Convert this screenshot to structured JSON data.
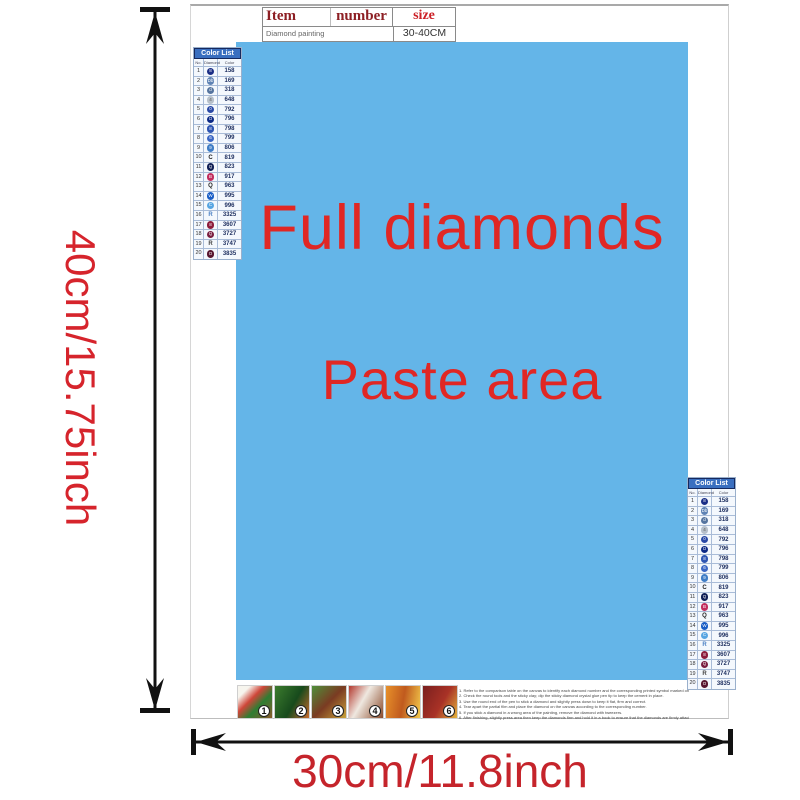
{
  "dimensions": {
    "height_label": "40cm/15.75inch",
    "width_label": "30cm/11.8inch"
  },
  "item_table": {
    "col_item": "Item",
    "col_number": "number",
    "col_size": "size",
    "item_value": "Diamond painting",
    "size_value": "30-40CM"
  },
  "paste_area": {
    "line1": "Full diamonds",
    "line2": "Paste area",
    "bg_color": "#64b5e8",
    "text_color": "#e02724"
  },
  "color_list": {
    "title": "Color List",
    "col_no": "No.",
    "col_diamond": "Diamond",
    "col_color": "Color",
    "rows": [
      {
        "no": "1",
        "symbol": "8",
        "circle": "#1b2e86",
        "code": "158"
      },
      {
        "no": "2",
        "symbol": "Db",
        "circle": "#5e82b4",
        "code": "169"
      },
      {
        "no": "3",
        "symbol": "d",
        "circle": "#55749f",
        "code": "318"
      },
      {
        "no": "4",
        "symbol": "4",
        "circle": "#b7c0ca",
        "glyph": "#555",
        "code": "648"
      },
      {
        "no": "5",
        "symbol": "0",
        "circle": "#2a49a6",
        "code": "792"
      },
      {
        "no": "6",
        "symbol": "O",
        "circle": "#0d2a86",
        "code": "796"
      },
      {
        "no": "7",
        "symbol": "8",
        "circle": "#2e55b2",
        "code": "798"
      },
      {
        "no": "8",
        "symbol": "6",
        "circle": "#3a66c4",
        "code": "799"
      },
      {
        "no": "9",
        "symbol": "9",
        "circle": "#3f7dc6",
        "code": "806"
      },
      {
        "no": "10",
        "symbol": "C",
        "letter": true,
        "letter_color": "#222",
        "code": "819"
      },
      {
        "no": "11",
        "symbol": "Q",
        "circle": "#101f56",
        "code": "823"
      },
      {
        "no": "12",
        "symbol": "B",
        "circle": "#c12d5e",
        "code": "917"
      },
      {
        "no": "13",
        "symbol": "Q",
        "letter": true,
        "letter_color": "#222",
        "code": "963"
      },
      {
        "no": "14",
        "symbol": "W",
        "circle": "#1a5ec6",
        "code": "995"
      },
      {
        "no": "15",
        "symbol": "C",
        "circle": "#57a5e2",
        "code": "996"
      },
      {
        "no": "16",
        "symbol": "R",
        "letter": true,
        "letter_color": "#4a80c4",
        "code": "3325"
      },
      {
        "no": "17",
        "symbol": "8",
        "circle": "#8d1c3c",
        "code": "3607"
      },
      {
        "no": "18",
        "symbol": "Q",
        "circle": "#7a1e40",
        "code": "3727"
      },
      {
        "no": "19",
        "symbol": "R",
        "letter": true,
        "letter_color": "#444",
        "code": "3747"
      },
      {
        "no": "20",
        "symbol": "O",
        "circle": "#58162f",
        "code": "3835"
      }
    ]
  },
  "steps": {
    "items": [
      {
        "num": "1"
      },
      {
        "num": "2"
      },
      {
        "num": "3"
      },
      {
        "num": "4"
      },
      {
        "num": "5"
      },
      {
        "num": "6"
      }
    ]
  },
  "instructions": {
    "lines": [
      "1. Refer to the comparison table on the canvas to identify each diamond number and the corresponding printed symbol marked on the bags.",
      "2. Check the round tools and the sticky clay; dip the sticky diamond crystal glue pen tip to keep the cement in place.",
      "3. Use the round end of the pen to stick a diamond and slightly press down to keep it flat, firm and correct.",
      "4. Tear apart the partial film and place the diamond on the canvas according to the corresponding number.",
      "5. If you stick a diamond in a wrong area of the painting, remove the diamond with tweezers.",
      "6. After finishing, slightly press area then keep the diamonds firm and hold it in a book to ensure that the diamonds are firmly attached."
    ]
  }
}
